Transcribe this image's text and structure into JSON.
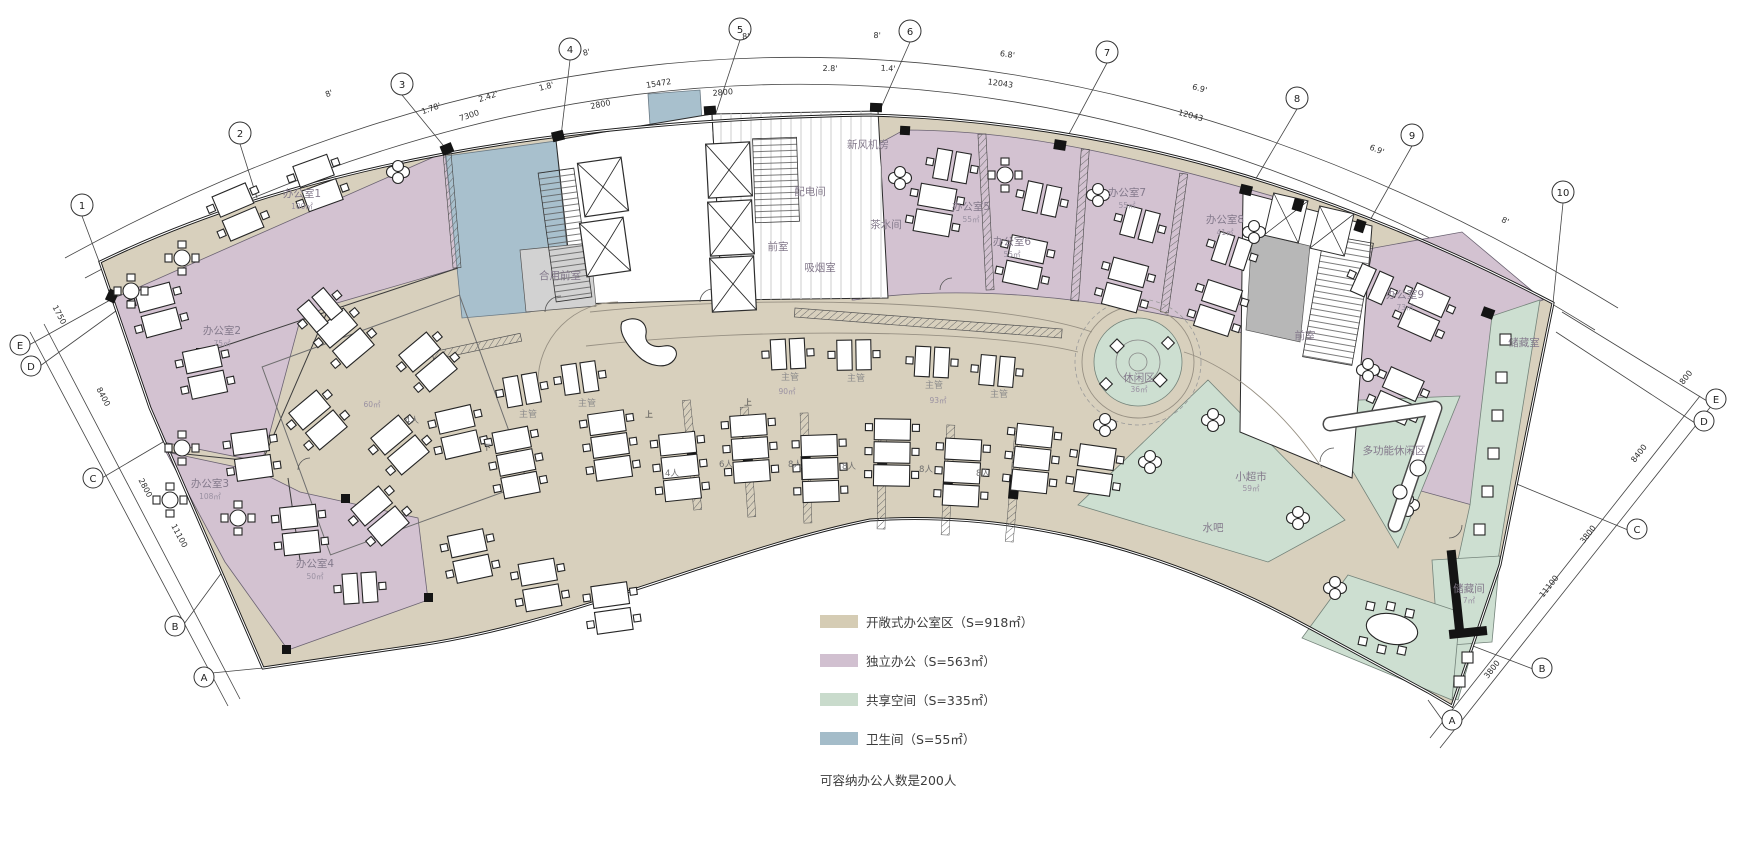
{
  "legend": {
    "items": [
      {
        "label": "开敞式办公室区（S=918㎡）",
        "color": "#d5ccb4"
      },
      {
        "label": "独立办公（S=563㎡）",
        "color": "#d1c0d0"
      },
      {
        "label": "共享空间（S=335㎡）",
        "color": "#c9dbcc"
      },
      {
        "label": "卫生间（S=55㎡）",
        "color": "#a4bcc9"
      }
    ],
    "note": "可容纳办公人数是200人"
  },
  "axes": {
    "top": [
      "1",
      "2",
      "3",
      "4",
      "5",
      "6",
      "7",
      "8",
      "9",
      "10"
    ],
    "left": [
      "E",
      "D",
      "C",
      "B",
      "A"
    ],
    "right": [
      "E",
      "D",
      "C",
      "B",
      "A"
    ]
  },
  "rooms": [
    {
      "name": "办公室1",
      "area": "100㎡"
    },
    {
      "name": "办公室2",
      "area": "75㎡"
    },
    {
      "name": "办公室3",
      "area": "108㎡"
    },
    {
      "name": "办公室4",
      "area": "50㎡"
    },
    {
      "name": "办公室5",
      "area": "55㎡"
    },
    {
      "name": "办公室6",
      "area": "55㎡"
    },
    {
      "name": "办公室7",
      "area": "55㎡"
    },
    {
      "name": "办公室8",
      "area": "41㎡"
    },
    {
      "name": "办公室9",
      "area": "73㎡"
    },
    {
      "name": "新风机房"
    },
    {
      "name": "配电间"
    },
    {
      "name": "茶水间"
    },
    {
      "name": "前室"
    },
    {
      "name": "吸烟室"
    },
    {
      "name": "合用前室"
    },
    {
      "name": "前室"
    },
    {
      "name": "储藏室"
    },
    {
      "name": "休闲区",
      "area": "36㎡"
    },
    {
      "name": "小超市",
      "area": "59㎡"
    },
    {
      "name": "水吧"
    },
    {
      "name": "多功能休闲区"
    },
    {
      "name": "储藏间",
      "area": "7㎡"
    }
  ],
  "strings": {
    "supervisor": "主管",
    "up": "上",
    "down": "下"
  },
  "open_areas": [
    "60㎡",
    "90㎡",
    "93㎡"
  ],
  "desk_labels": [
    "4人",
    "4人",
    "6人",
    "8人",
    "8人",
    "8人",
    "8人"
  ],
  "dims_top": [
    "8'",
    "1.78'",
    "2.42'",
    "1.8'",
    "7300",
    "2800",
    "15472",
    "8'",
    "2800",
    "8'",
    "2.8'",
    "1.4'",
    "8'",
    "6.8'",
    "12043",
    "6.9'",
    "12043",
    "6.9'",
    "8'"
  ],
  "dims_left": [
    "1750",
    "8400",
    "2800",
    "11100"
  ],
  "dims_right": [
    "800",
    "8400",
    "3800",
    "11100",
    "3800"
  ]
}
